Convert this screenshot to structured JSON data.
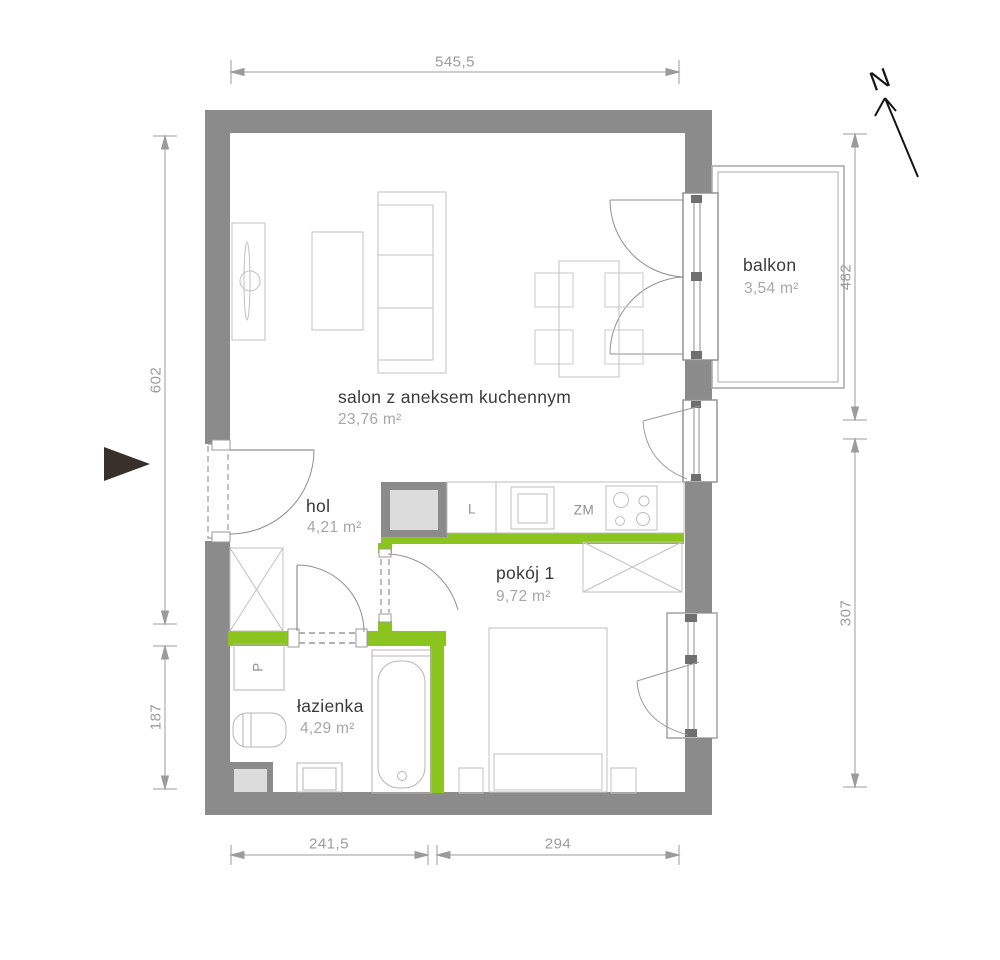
{
  "title": "apartment floor plan",
  "colors": {
    "wall": "#8b8b8b",
    "accent_green": "#8bc41e",
    "shaft_fill": "#dcdcdc",
    "dimension_gray": "#9b9b9b",
    "room_name_text": "#3a3a3a",
    "room_area_text": "#a6a6a6",
    "entry_arrow": "#38302a"
  },
  "rooms": [
    {
      "id": "salon",
      "name": "salon z aneksem kuchennym",
      "area": "23,76 m²"
    },
    {
      "id": "hol",
      "name": "hol",
      "area": "4,21 m²"
    },
    {
      "id": "pokoj1",
      "name": "pokój 1",
      "area": "9,72 m²"
    },
    {
      "id": "lazienka",
      "name": "łazienka",
      "area": "4,29 m²"
    },
    {
      "id": "balkon",
      "name": "balkon",
      "area": "3,54 m²"
    }
  ],
  "dimensions": {
    "top": "545,5",
    "bottom_left": "241,5",
    "bottom_right": "294",
    "left_upper": "602",
    "left_lower": "187",
    "right_upper": "482",
    "right_lower": "307"
  },
  "appliances": {
    "fridge": "L",
    "dishwasher": "ZM",
    "washer": "P"
  },
  "compass": {
    "north": "N"
  }
}
